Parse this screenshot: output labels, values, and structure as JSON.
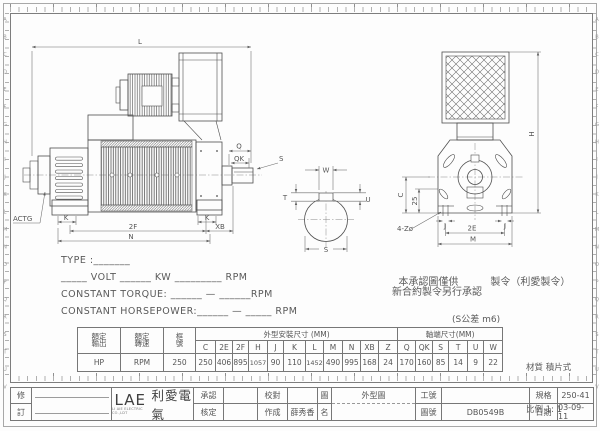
{
  "sheet": {
    "row_letters": "ABCDEFGHIJKLMNOPQRSTUV"
  },
  "dims": {
    "L": "L",
    "Q": "Q",
    "QK": "QK",
    "S2": "S",
    "K1": "K",
    "K2": "K",
    "F2": "2F",
    "XB": "XB",
    "N": "N",
    "ACTG": "ACTG",
    "W": "W",
    "T": "T",
    "U": "U",
    "S1": "S",
    "H": "H",
    "C": "C",
    "D25": "25",
    "J1": "J",
    "J2": "J",
    "E2": "2E",
    "M": "M",
    "Z4": "4-Zø"
  },
  "spec": {
    "type_line": "TYPE :_______",
    "volt_line": "_____ VOLT ______ KW _________ RPM",
    "torque_line": "CONSTANT TORQUE: ______ — ______RPM",
    "hp_line": "CONSTANT HORSEPOWER:______ — _____ RPM"
  },
  "notes": {
    "line1a": "本承認圖僅供",
    "line1b": "製令（利愛製令）",
    "line2": "新合約製令另行承認",
    "tolerance": "(S公差 m6)"
  },
  "dim_table": {
    "rated_output_label": "額定\n輸出",
    "rated_speed_label": "額定\n轉速",
    "frame_label": "框\n號",
    "group_outline": "外型安裝尺寸 (MM)",
    "group_shaft": "軸端尺寸(MM)",
    "columns": [
      "C",
      "2E",
      "2F",
      "H",
      "J",
      "K",
      "L",
      "M",
      "N",
      "XB",
      "Z",
      "Q",
      "QK",
      "S",
      "T",
      "U",
      "W"
    ],
    "rated_output_value": "HP",
    "rated_speed_value": "RPM",
    "frame_value": "250",
    "values": [
      "250",
      "406",
      "895",
      "1057",
      "90",
      "110",
      "1452",
      "490",
      "995",
      "168",
      "24",
      "170",
      "160",
      "85",
      "14",
      "9",
      "22"
    ]
  },
  "material_note": {
    "material": "材質 積片式",
    "scale": "比例 1: 1"
  },
  "title_block": {
    "rev_top": "修",
    "rev_bottom": "訂",
    "logo": "LAE",
    "logo_cn": "利愛電氣",
    "logo_sub": "LI AIE ELECTRIC CO.,LDT",
    "approve_label": "承認",
    "check_label": "核定",
    "proof_label": "校對",
    "made_label": "作成",
    "made_value": "薛秀香",
    "fig_label": "圖",
    "name_label": "名",
    "drawing_name": "外型圖",
    "work_no_label": "工號",
    "work_no_value": "",
    "drawing_no_label": "圖號",
    "drawing_no_value": "DB0549B",
    "spec_label": "規格",
    "spec_value": "250-41",
    "date_label": "日期",
    "date_value": "03-09-11"
  }
}
